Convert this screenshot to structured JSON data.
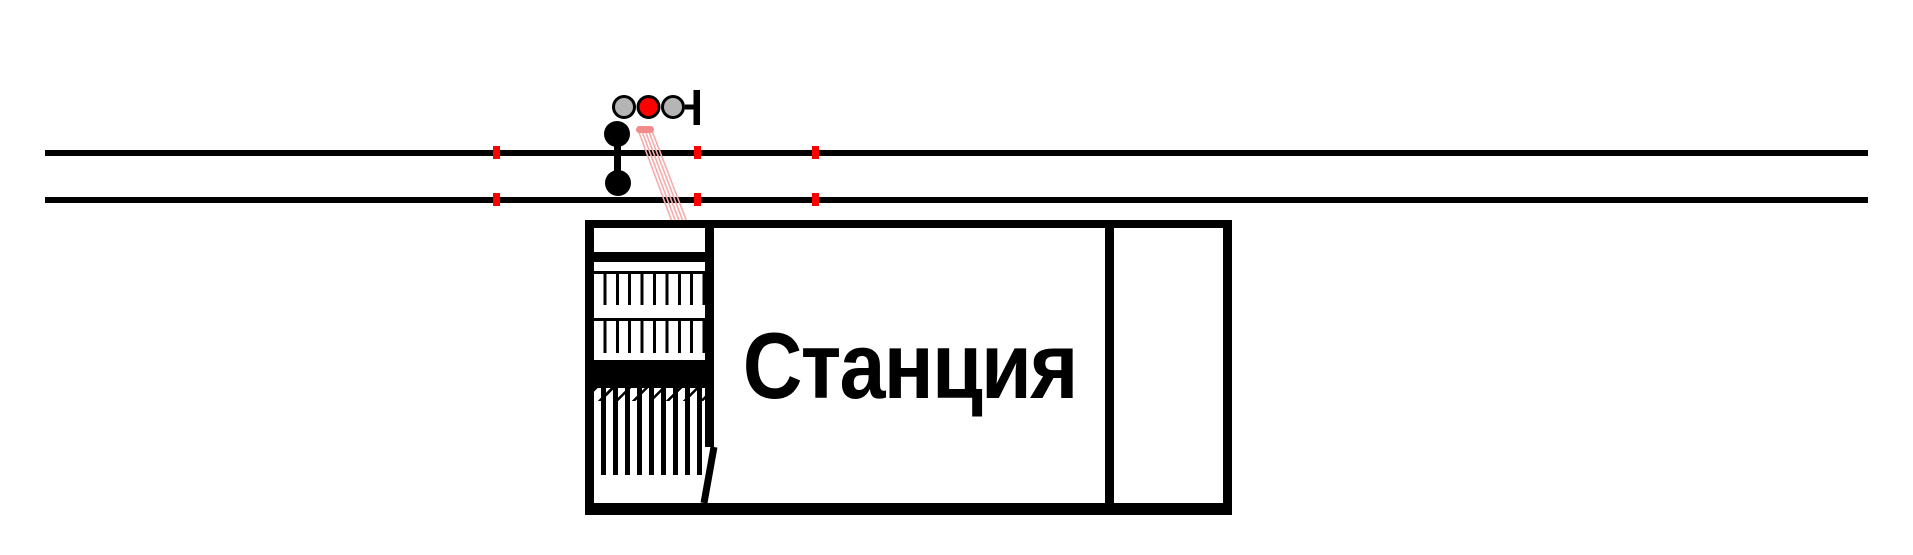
{
  "diagram": {
    "station_label": "Станция",
    "signal_lamps": [
      "gray",
      "red",
      "gray"
    ],
    "marker_positions_x": [
      496,
      697,
      815
    ],
    "colors": {
      "line": "#000000",
      "marker": "#ff0000",
      "lamp_gray": "#b5b5b5",
      "lamp_red": "#ff0000",
      "pink_cap": "#f28b8b",
      "pink_line": "#f7abab"
    }
  }
}
